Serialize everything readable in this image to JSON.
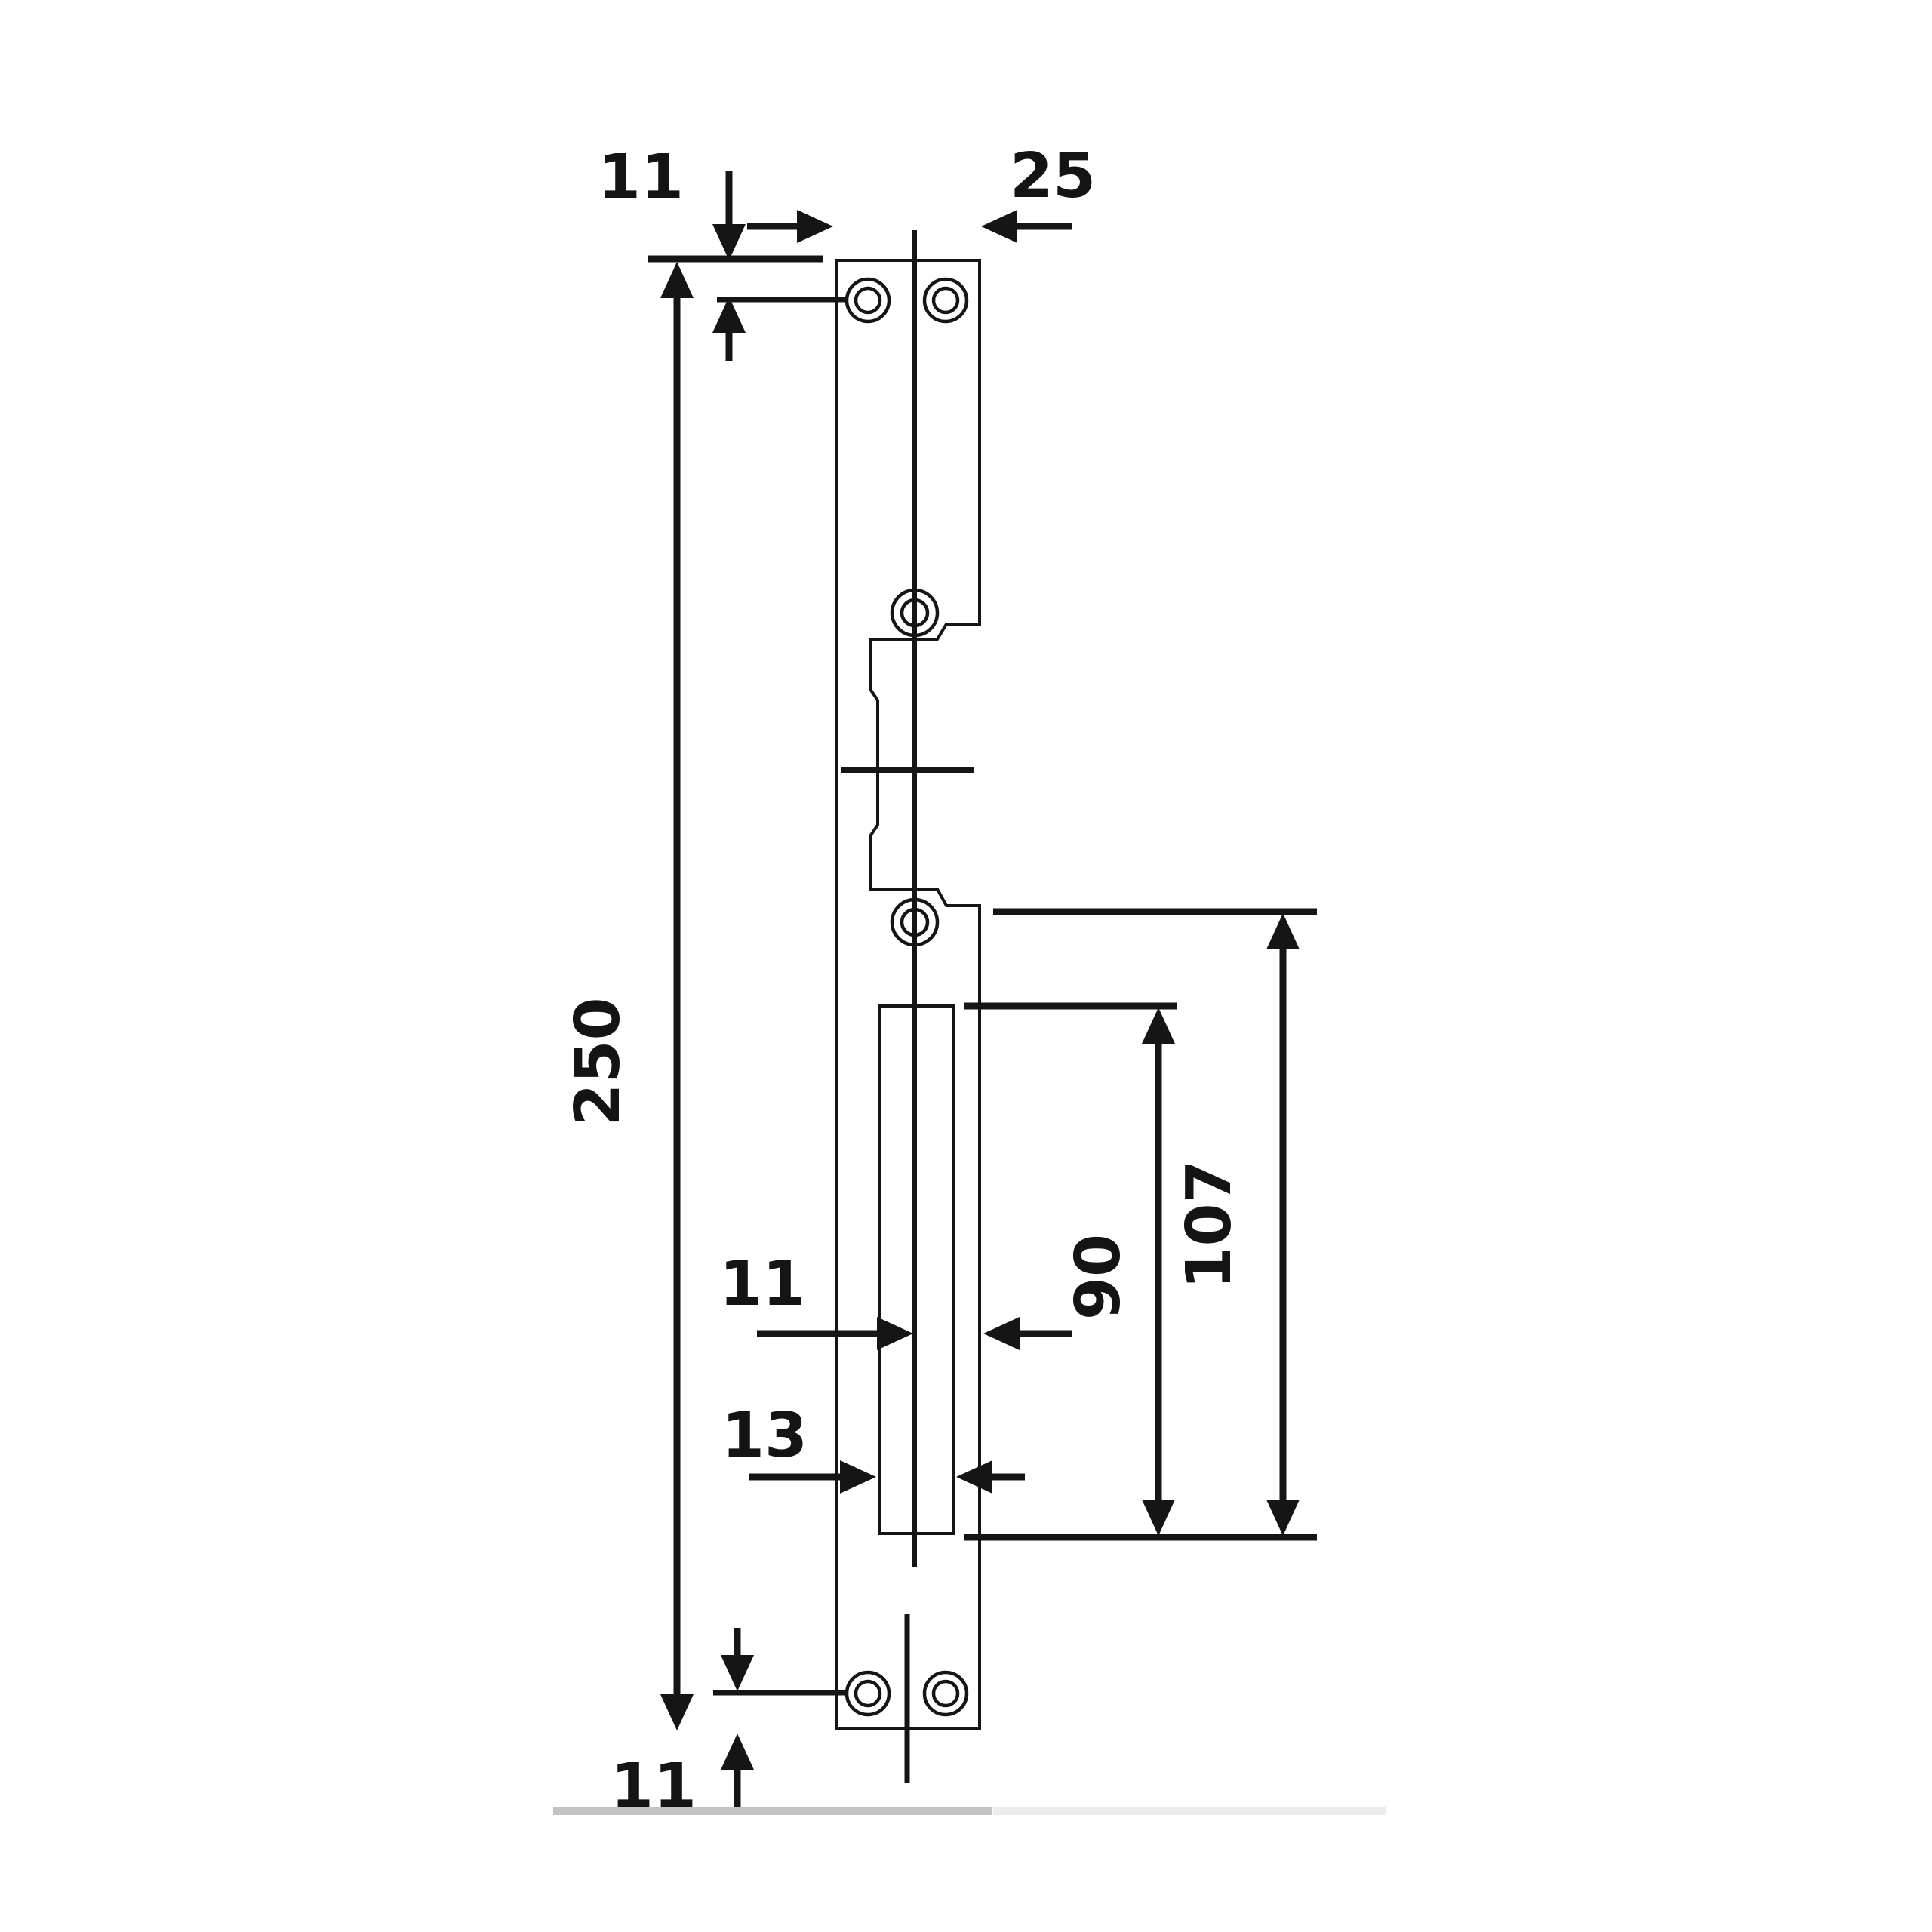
{
  "drawing": {
    "subject": "strike-plate-dimension-drawing",
    "dimensions": {
      "hole_offset_top": {
        "label": "11"
      },
      "plate_width": {
        "label": "25"
      },
      "plate_length": {
        "label": "250"
      },
      "shoulder_to_opening": {
        "label": "107"
      },
      "opening_height": {
        "label": "90"
      },
      "center_to_edge": {
        "label": "11"
      },
      "opening_width": {
        "label": "13"
      },
      "hole_offset_bottom": {
        "label": "11"
      }
    }
  },
  "colors": {
    "ink": "#151515",
    "label": "#141414",
    "background": "#ffffff",
    "baseline_dark": "#c3c3c3",
    "baseline_light": "#ececec"
  }
}
